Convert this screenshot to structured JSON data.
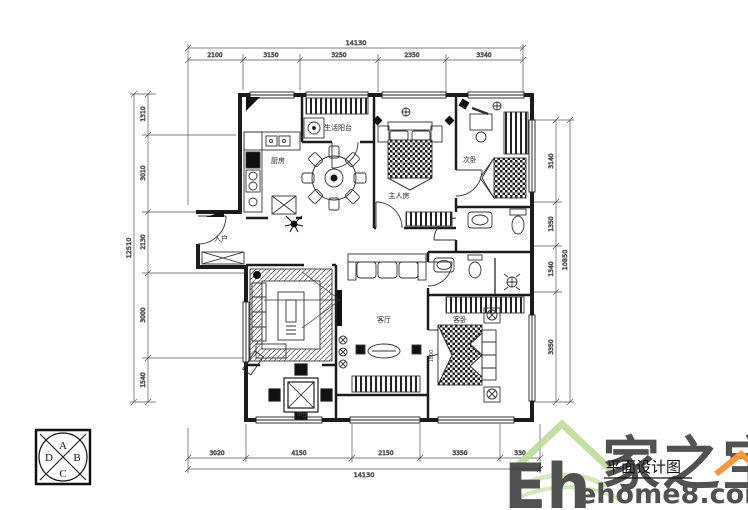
{
  "document": {
    "title": "平面设计图"
  },
  "watermark": {
    "brand_cn": "家之宝",
    "brand_latin": "Eh",
    "site": "ehome8.com"
  },
  "compass": {
    "top": "A",
    "right": "B",
    "bottom": "C",
    "left": "D"
  },
  "dimensions": {
    "top": {
      "total": "14130",
      "segments": [
        "2100",
        "3150",
        "3250",
        "2350",
        "3340"
      ]
    },
    "bottom": {
      "total": "14130",
      "segments": [
        "3020",
        "4150",
        "2150",
        "3350",
        "330"
      ]
    },
    "left": {
      "total": "12510",
      "segments": [
        "1310",
        "3010",
        "2130",
        "3000",
        "1540"
      ]
    },
    "right": {
      "total": "10850",
      "segments": [
        "3140",
        "1350",
        "1340",
        "3350"
      ]
    }
  },
  "room_labels": {
    "kitchen": "厨房",
    "service_balcony": "生活阳台",
    "master_bedroom": "主人房",
    "second_bedroom": "次卧",
    "entry": "入户",
    "living_room": "客厅",
    "guest_bedroom": "客卧",
    "balcony": "阳台"
  },
  "annotations": {
    "bed_width": "1800"
  },
  "colors": {
    "line": "#1c1c1c",
    "watermark_green": "#b9d893",
    "watermark_orange": "#f6861f"
  }
}
